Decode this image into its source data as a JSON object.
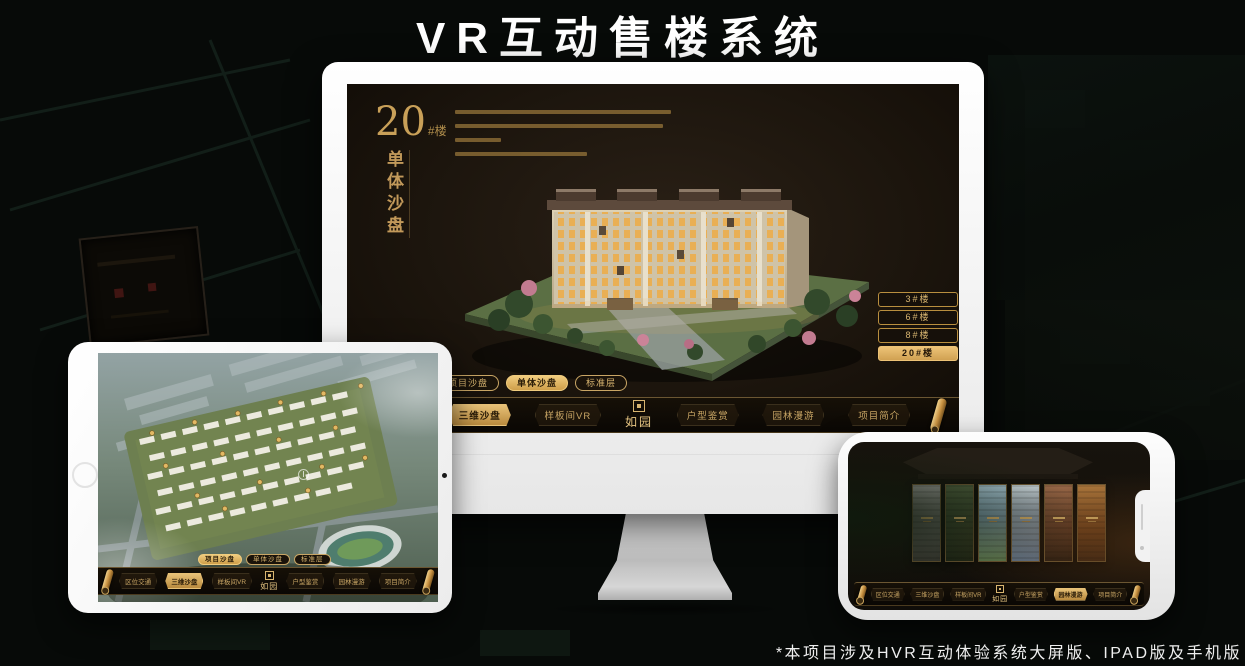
{
  "page": {
    "title": "VR互动售楼系统",
    "footnote": "*本项目涉及HVR互动体验系统大屏版、IPAD版及手机版"
  },
  "colors": {
    "gold": "#c9a665",
    "gold_bright": "#edc377",
    "active_text": "#241708",
    "screen_bg": "#1c150d",
    "monitor_body": "#f2f2f2"
  },
  "logo": {
    "name": "如园",
    "seal_icon": "seal-square"
  },
  "monitor": {
    "block_no": "20",
    "block_suffix": "#楼",
    "subtitle": "单体沙盘",
    "floor_buttons": [
      {
        "label": "3#楼",
        "active": false
      },
      {
        "label": "6#楼",
        "active": false
      },
      {
        "label": "8#楼",
        "active": false
      },
      {
        "label": "20#楼",
        "active": true
      }
    ],
    "tabs": [
      {
        "label": "项目沙盘",
        "active": false
      },
      {
        "label": "单体沙盘",
        "active": true
      },
      {
        "label": "标准层",
        "active": false
      }
    ],
    "menu": [
      {
        "label": "区位交通",
        "active": false
      },
      {
        "label": "三维沙盘",
        "active": true
      },
      {
        "label": "样板间VR",
        "active": false
      },
      {
        "label": "户型鉴赏",
        "active": false
      },
      {
        "label": "园林漫游",
        "active": false
      },
      {
        "label": "项目简介",
        "active": false
      }
    ]
  },
  "tablet": {
    "tabs": [
      {
        "label": "项目沙盘",
        "active": true
      },
      {
        "label": "单体沙盘",
        "active": false
      },
      {
        "label": "标准层",
        "active": false
      }
    ],
    "menu": [
      {
        "label": "区位交通",
        "active": false
      },
      {
        "label": "三维沙盘",
        "active": true
      },
      {
        "label": "样板间VR",
        "active": false
      },
      {
        "label": "户型鉴赏",
        "active": false
      },
      {
        "label": "园林漫游",
        "active": false
      },
      {
        "label": "项目简介",
        "active": false
      }
    ]
  },
  "phone": {
    "menu": [
      {
        "label": "区位交通",
        "active": false
      },
      {
        "label": "三维沙盘",
        "active": false
      },
      {
        "label": "样板间VR",
        "active": false
      },
      {
        "label": "户型鉴赏",
        "active": false
      },
      {
        "label": "园林漫游",
        "active": true
      },
      {
        "label": "项目简介",
        "active": false
      }
    ],
    "gallery_panels": 6
  }
}
